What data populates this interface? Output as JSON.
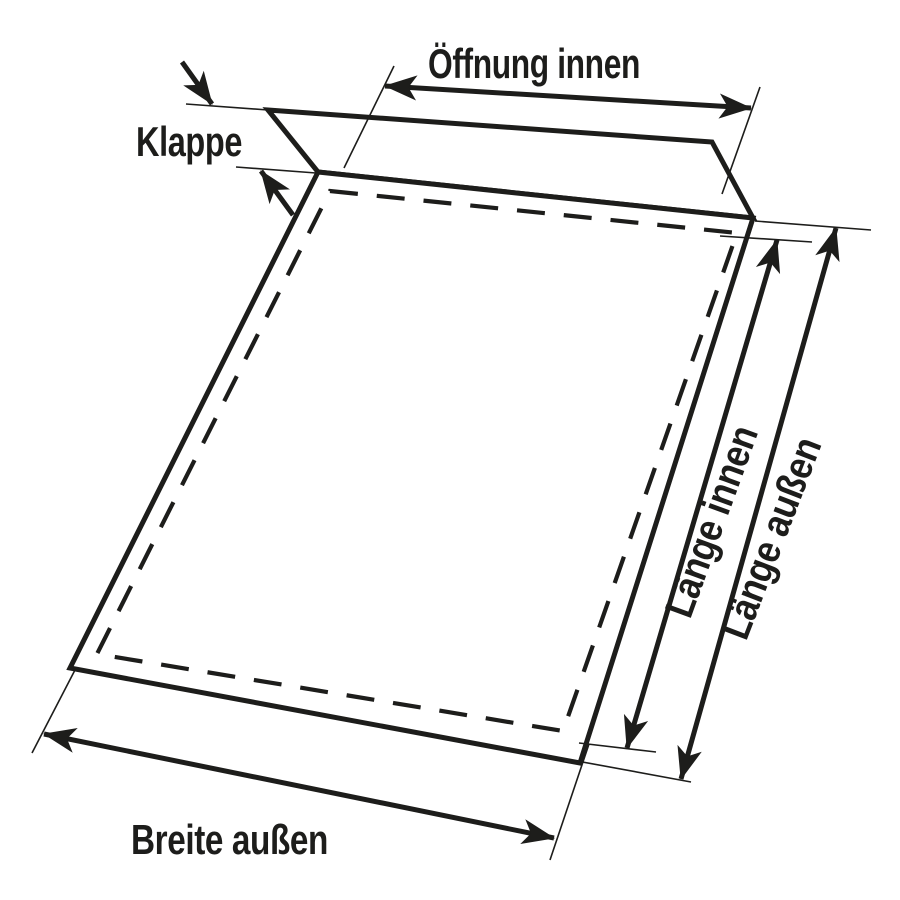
{
  "diagram": {
    "background_color": "#ffffff",
    "line_color": "#1d1d1b",
    "labels": {
      "oeffnung_innen": "Öffnung innen",
      "klappe": "Klappe",
      "laenge_innen": "Länge innen",
      "laenge_aussen": "Länge außen",
      "breite_aussen": "Breite außen"
    }
  }
}
